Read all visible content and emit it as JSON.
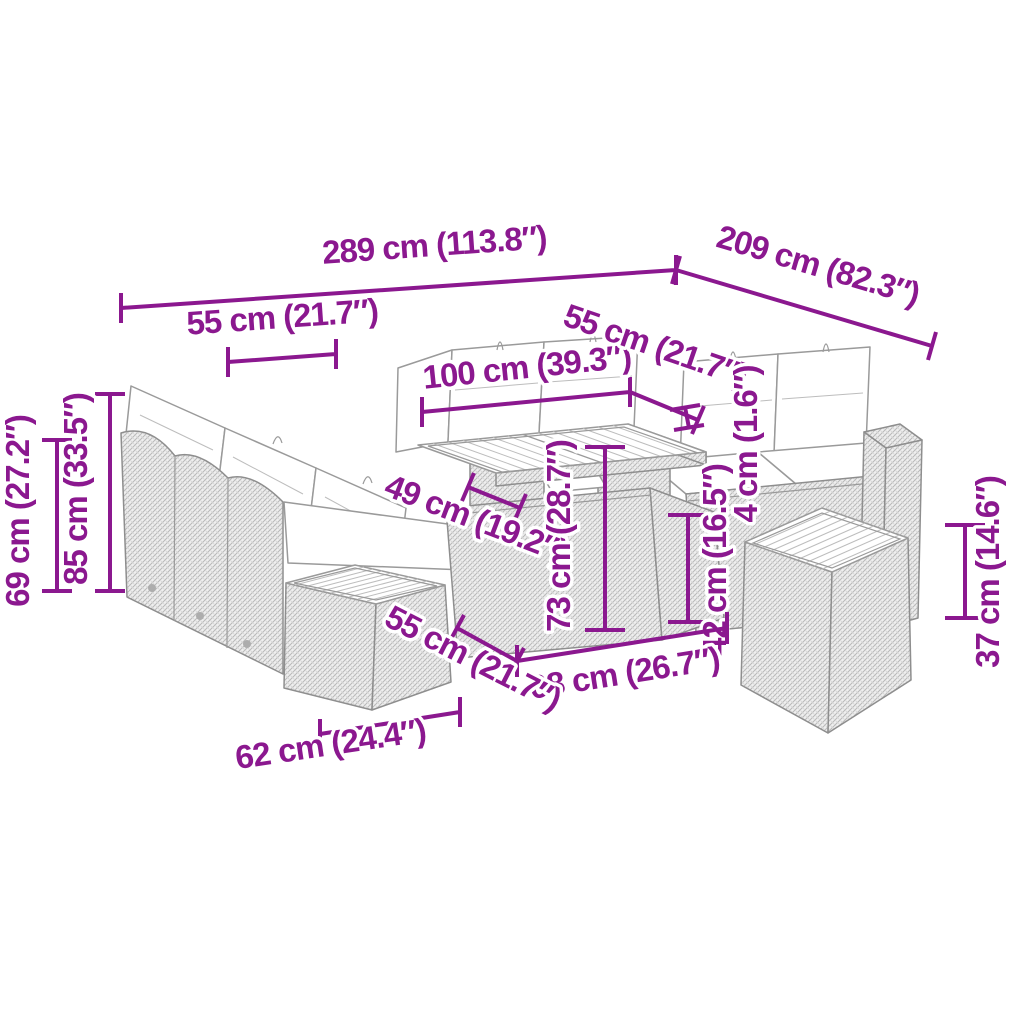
{
  "diagram": {
    "type": "product-dimension-diagram",
    "subject": "poly-rattan garden lounge set with table and footstools",
    "accent_color": "#8B188F",
    "outline_color": "#8E8E8E",
    "background": "#FFFFFF",
    "dims": {
      "total_width": "289 cm (113.8″)",
      "total_depth": "209 cm (82.3″)",
      "seat_width_back": "55 cm (21.7″)",
      "seat_width_side": "55 cm (21.7″)",
      "table_width": "100 cm (39.3″)",
      "back_height": "69 cm (27.2″)",
      "total_height": "85 cm (33.5″)",
      "seat_depth": "49 cm (19.2″)",
      "table_height": "73 cm (28.7″)",
      "tabletop_thickness": "4 cm (1.6″)",
      "table_base_height": "42 cm (16.5″)",
      "table_base_width": "68 cm (26.7″)",
      "stool_depth": "55 cm (21.7″)",
      "stool_width": "62 cm (24.4″)",
      "stool_height": "37 cm (14.6″)"
    }
  }
}
